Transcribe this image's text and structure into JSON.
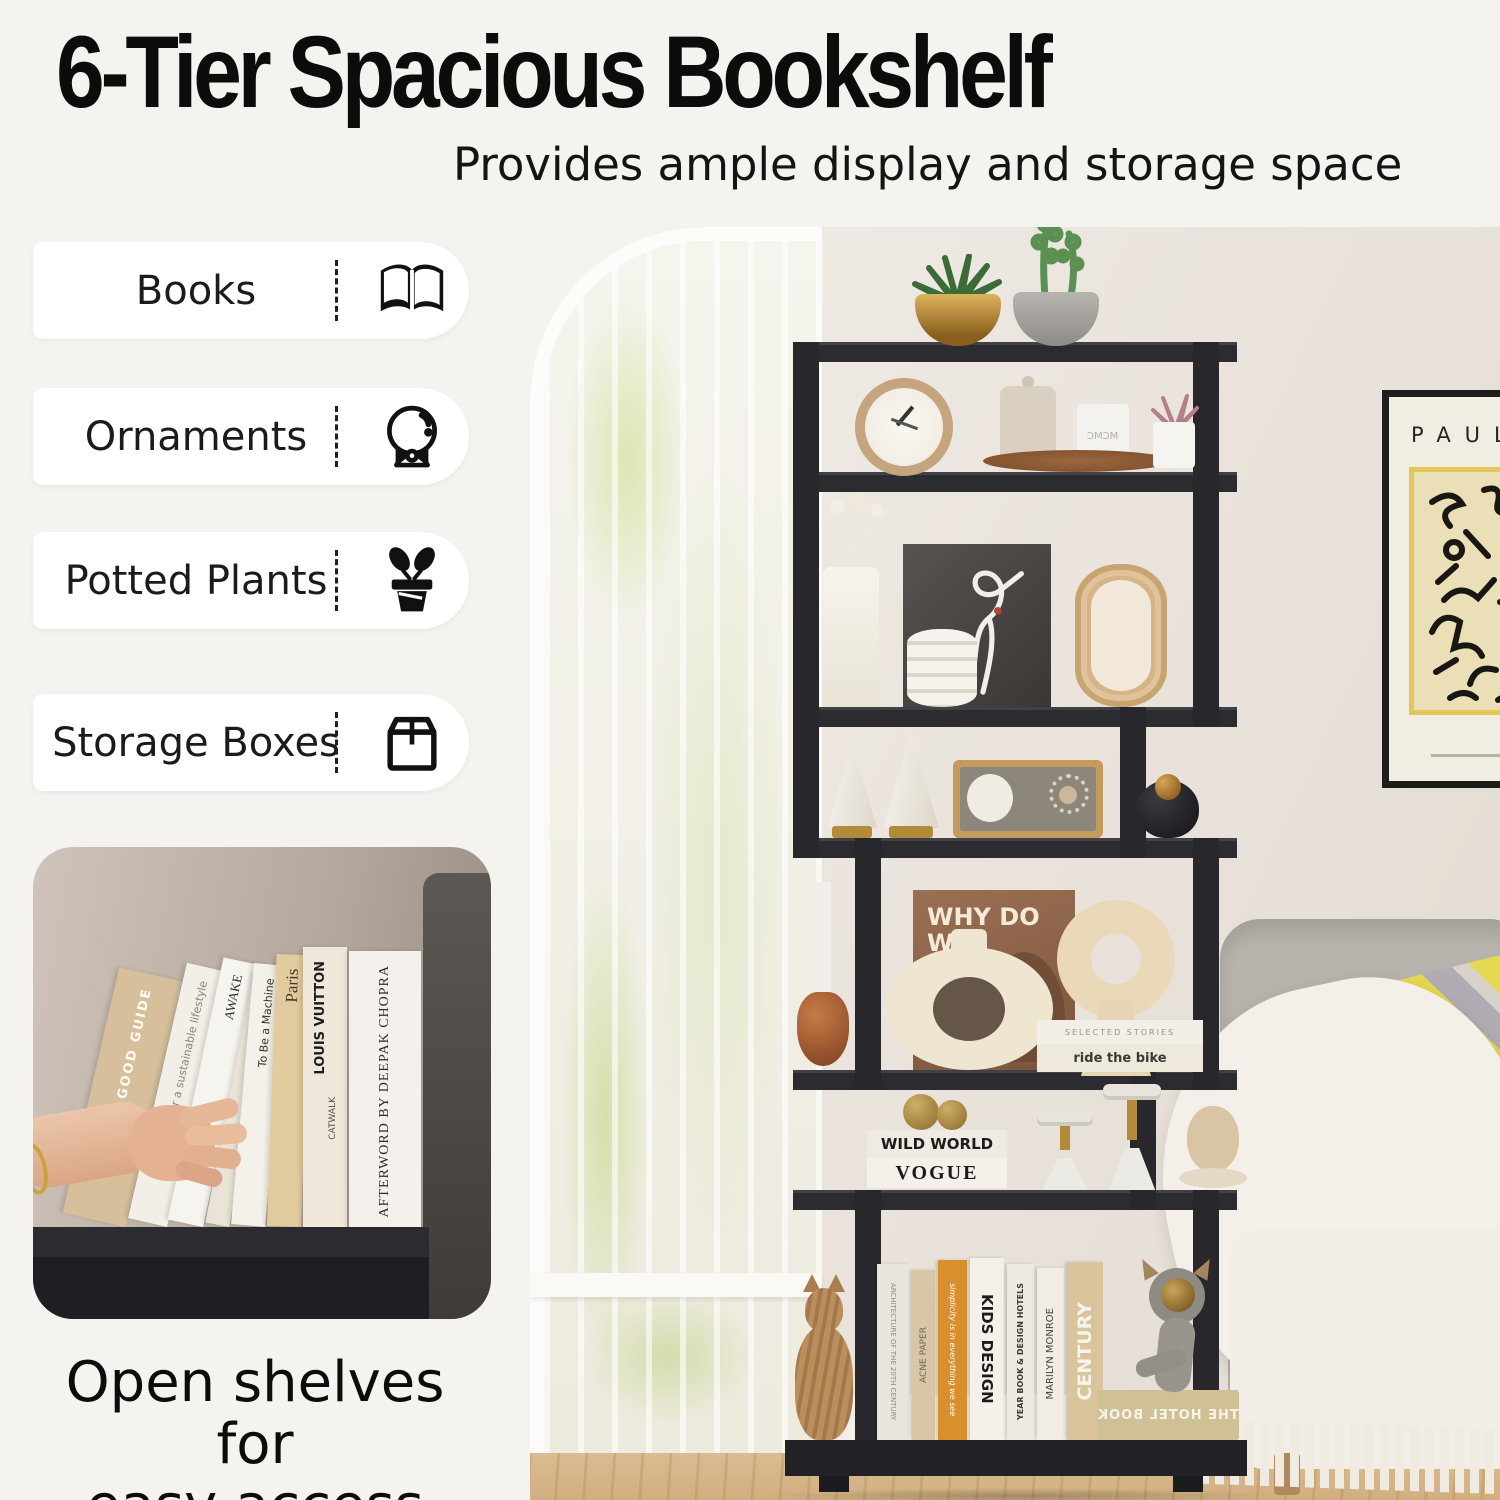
{
  "colors": {
    "page_bg": "#f5f3f0",
    "accent_black": "#111111",
    "pill_bg": "#ffffff",
    "shelf_black": "#2b2b2e",
    "floor_wood": "#d9b88b",
    "pillow_yellow": "#e5d74f"
  },
  "header": {
    "title": "6-Tier Spacious Bookshelf",
    "subtitle": "Provides ample display and storage space"
  },
  "features": [
    {
      "label": "Books",
      "icon": "open-book-icon"
    },
    {
      "label": "Ornaments",
      "icon": "crystal-ball-icon"
    },
    {
      "label": "Potted Plants",
      "icon": "potted-plant-icon"
    },
    {
      "label": "Storage Boxes",
      "icon": "storage-box-icon"
    }
  ],
  "inset": {
    "caption_line1": "Open shelves for",
    "caption_line2": "easy access",
    "books": [
      {
        "title": "IS A GOOD GUIDE"
      },
      {
        "title": "for a sustainable lifestyle"
      },
      {
        "title": "AWAKE"
      },
      {
        "title": "To Be a Machine",
        "author": "Mark O'Connell"
      },
      {
        "title": "Paris",
        "publisher": "TASCHEN"
      },
      {
        "title": "LOUIS VUITTON",
        "subtitle": "CATWALK"
      },
      {
        "title": "AFTERWORD BY DEEPAK CHOPRA"
      }
    ]
  },
  "photo": {
    "poster": {
      "title": "PAUL"
    },
    "tier1": {
      "candle_label": "MCMC"
    },
    "tier4": {
      "book_title": "WHY DO WE",
      "stack_top": "SELECTED STORIES",
      "stack_bottom": "ride the bike"
    },
    "tier5": {
      "stack_top": "WILD WORLD",
      "stack_bottom": "VOGUE"
    },
    "tier6": {
      "spine1": "ARCHITECTURE OF THE 20TH CENTURY",
      "spine2": "ACNE PAPER",
      "spine3": "simplicity is in everything we see",
      "spine4": "KIDS DESIGN",
      "spine5": "YEAR BOOK & DESIGN HOTELS",
      "spine6": "MARILYN MONROE",
      "spine7": "CENTURY",
      "flat_book": "THE HOTEL BOOK"
    }
  }
}
